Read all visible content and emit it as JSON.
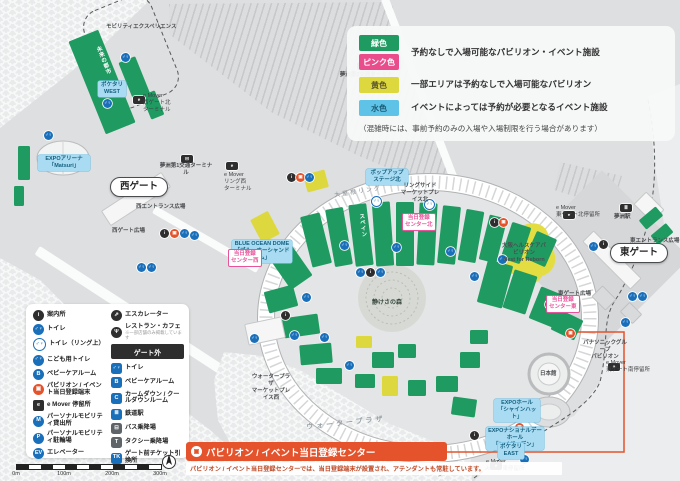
{
  "colors": {
    "green": "#1f9b62",
    "pink": "#ea4d8b",
    "yellow": "#ddd83e",
    "light_blue": "#5fc3e8",
    "orange": "#e4532c",
    "toilet_blue": "#1a6fba"
  },
  "legend": {
    "items": [
      {
        "chip": "緑色",
        "chip_bg": "#1f9b62",
        "desc": "予約なしで入場可能なパビリオン・イベント施設"
      },
      {
        "chip": "ピンク色",
        "chip_bg": "#ea4d8b",
        "desc": ""
      },
      {
        "chip": "黄色",
        "chip_bg": "#ddd83e",
        "desc": "一部エリアは予約なしで入場可能なパビリオン"
      },
      {
        "chip": "水色",
        "chip_bg": "#5fc3e8",
        "desc": "イベントによっては予約が必要となるイベント施設"
      }
    ],
    "note": "（混雑時には、事前予約のみの入場や入場制限を行う場合があります）"
  },
  "facility_legend": {
    "left": [
      {
        "icon": "info-icon",
        "style": "black-circle",
        "glyph": "i",
        "label": "案内所"
      },
      {
        "icon": "toilet-icon",
        "style": "blue-circle",
        "glyph": "♂♀",
        "label": "トイレ"
      },
      {
        "icon": "toilet-ring-icon",
        "style": "blue-ring",
        "glyph": "♂♀",
        "label": "トイレ（リング上）"
      },
      {
        "icon": "kids-toilet-icon",
        "style": "blue-circle",
        "glyph": "♂♀",
        "label": "こども用トイレ"
      },
      {
        "icon": "babycare-icon",
        "style": "blue-circle",
        "glyph": "B",
        "label": "ベビーケアルーム"
      },
      {
        "icon": "registration-terminal-icon",
        "style": "orange-circle",
        "glyph": "▣",
        "label": "パビリオン / イベント当日登録端末"
      },
      {
        "icon": "emover-stop-icon",
        "style": "black-square",
        "glyph": "e",
        "label": "e Mover 停留所"
      },
      {
        "icon": "mobility-rental-icon",
        "style": "blue-circle",
        "glyph": "M",
        "label": "パーソナルモビリティ貸出所"
      },
      {
        "icon": "mobility-parking-icon",
        "style": "blue-circle",
        "glyph": "P",
        "label": "パーソナルモビリティ駐輪場"
      },
      {
        "icon": "elevator-icon",
        "style": "blue-circle",
        "glyph": "EV",
        "label": "エレベーター"
      }
    ],
    "right_top": [
      {
        "icon": "escalator-icon",
        "style": "black-circle",
        "glyph": "⇗",
        "label": "エスカレーター"
      },
      {
        "icon": "restaurant-icon",
        "style": "black-circle",
        "glyph": "Ψ",
        "label": "レストラン・カフェ",
        "note": "※一部店舗のみ掲載しています"
      }
    ],
    "gate_header": "ゲート外",
    "right_bottom": [
      {
        "icon": "gate-toilet-icon",
        "style": "blue-square",
        "glyph": "♂♀",
        "label": "トイレ"
      },
      {
        "icon": "gate-babycare-icon",
        "style": "blue-square",
        "glyph": "B",
        "label": "ベビーケアルーム"
      },
      {
        "icon": "calmdown-icon",
        "style": "blue-square",
        "glyph": "C",
        "label": "カームダウン / クールダウンルーム"
      },
      {
        "icon": "station-icon",
        "style": "blue-square",
        "glyph": "≣",
        "label": "鉄道駅"
      },
      {
        "icon": "bus-icon",
        "style": "gray-square",
        "glyph": "⊟",
        "label": "バス乗降場"
      },
      {
        "icon": "taxi-icon",
        "style": "gray-square",
        "glyph": "T",
        "label": "タクシー乗降場"
      },
      {
        "icon": "ticket-icon",
        "style": "blue-square",
        "glyph": "TK",
        "label": "ゲート前チケット引換所"
      }
    ]
  },
  "banner": {
    "title": "パビリオン / イベント当日登録センター",
    "desc": "パビリオン / イベント当日登録センターでは、当日登録端末が設置され、アテンダントも常駐しています。"
  },
  "scale": {
    "ticks": [
      "0m",
      "100m",
      "200m",
      "300m"
    ]
  },
  "map": {
    "icon_styles": {
      "wc": "blue-circle",
      "wcr": "blue-ring",
      "info": "black-circle",
      "reg": "orange-circle",
      "emover": "black-rect",
      "busT": "black-rect",
      "station": "black-rect"
    },
    "icon_glyphs": {
      "wc": "♂♀",
      "wcr": "♂♀",
      "info": "i",
      "reg": "▣",
      "emover": "e",
      "busT": "⊟",
      "station": "≣"
    },
    "blocks": [
      {
        "x": 86,
        "y": 32,
        "w": 32,
        "h": 100,
        "r": -22,
        "c": "green",
        "n": "pavilion-future-city"
      },
      {
        "x": 126,
        "y": 58,
        "w": 18,
        "h": 44,
        "r": -22,
        "c": "green"
      },
      {
        "x": 146,
        "y": 92,
        "w": 14,
        "h": 26,
        "r": -22,
        "c": "green"
      },
      {
        "x": 18,
        "y": 146,
        "w": 12,
        "h": 34,
        "r": 0,
        "c": "green"
      },
      {
        "x": 14,
        "y": 186,
        "w": 10,
        "h": 20,
        "r": 0,
        "c": "green"
      },
      {
        "x": 100,
        "y": 190,
        "w": 70,
        "h": 16,
        "r": -33,
        "c": "white",
        "n": "west-gate-canopy"
      },
      {
        "x": 578,
        "y": 252,
        "w": 66,
        "h": 14,
        "r": 45,
        "c": "white",
        "n": "east-gate-canopy"
      },
      {
        "x": 636,
        "y": 198,
        "w": 24,
        "h": 16,
        "r": 45,
        "c": "white"
      },
      {
        "x": 305,
        "y": 172,
        "w": 22,
        "h": 18,
        "r": -15,
        "c": "yellow"
      },
      {
        "x": 255,
        "y": 214,
        "w": 20,
        "h": 26,
        "r": -28,
        "c": "yellow",
        "n": "blue-ocean-dome"
      },
      {
        "x": 306,
        "y": 214,
        "w": 20,
        "h": 52,
        "r": -14,
        "c": "green"
      },
      {
        "x": 330,
        "y": 208,
        "w": 18,
        "h": 58,
        "r": -10,
        "c": "green"
      },
      {
        "x": 352,
        "y": 204,
        "w": 18,
        "h": 62,
        "r": -7,
        "c": "green",
        "n": "pavilion-spain"
      },
      {
        "x": 374,
        "y": 202,
        "w": 18,
        "h": 64,
        "r": -4,
        "c": "green"
      },
      {
        "x": 396,
        "y": 202,
        "w": 18,
        "h": 64,
        "r": 0,
        "c": "green"
      },
      {
        "x": 418,
        "y": 203,
        "w": 18,
        "h": 62,
        "r": 3,
        "c": "green"
      },
      {
        "x": 440,
        "y": 206,
        "w": 18,
        "h": 58,
        "r": 6,
        "c": "green"
      },
      {
        "x": 462,
        "y": 210,
        "w": 18,
        "h": 52,
        "r": 10,
        "c": "green"
      },
      {
        "x": 484,
        "y": 216,
        "w": 18,
        "h": 46,
        "r": 14,
        "c": "green"
      },
      {
        "x": 506,
        "y": 224,
        "w": 20,
        "h": 38,
        "r": 18,
        "c": "green"
      },
      {
        "x": 530,
        "y": 234,
        "w": 22,
        "h": 30,
        "r": 24,
        "c": "green"
      },
      {
        "x": 278,
        "y": 248,
        "w": 26,
        "h": 38,
        "r": -35,
        "c": "green"
      },
      {
        "x": 266,
        "y": 288,
        "w": 30,
        "h": 22,
        "r": -15,
        "c": "green"
      },
      {
        "x": 283,
        "y": 316,
        "w": 36,
        "h": 20,
        "r": -8,
        "c": "green"
      },
      {
        "x": 300,
        "y": 344,
        "w": 32,
        "h": 20,
        "r": -5,
        "c": "green"
      },
      {
        "x": 246,
        "y": 320,
        "w": 36,
        "h": 20,
        "r": -12,
        "c": "white"
      },
      {
        "x": 316,
        "y": 368,
        "w": 26,
        "h": 16,
        "r": 0,
        "c": "green"
      },
      {
        "x": 356,
        "y": 336,
        "w": 16,
        "h": 12,
        "r": 0,
        "c": "yellow"
      },
      {
        "x": 372,
        "y": 352,
        "w": 22,
        "h": 16,
        "r": 0,
        "c": "green"
      },
      {
        "x": 398,
        "y": 344,
        "w": 18,
        "h": 14,
        "r": 0,
        "c": "green"
      },
      {
        "x": 355,
        "y": 374,
        "w": 20,
        "h": 14,
        "r": 0,
        "c": "green"
      },
      {
        "x": 382,
        "y": 376,
        "w": 16,
        "h": 20,
        "r": 0,
        "c": "yellow"
      },
      {
        "x": 408,
        "y": 380,
        "w": 18,
        "h": 16,
        "r": 0,
        "c": "green"
      },
      {
        "x": 436,
        "y": 376,
        "w": 22,
        "h": 16,
        "r": 0,
        "c": "green"
      },
      {
        "x": 452,
        "y": 398,
        "w": 24,
        "h": 18,
        "r": 8,
        "c": "green"
      },
      {
        "x": 460,
        "y": 352,
        "w": 20,
        "h": 16,
        "r": 0,
        "c": "green"
      },
      {
        "x": 470,
        "y": 330,
        "w": 18,
        "h": 14,
        "r": 0,
        "c": "green"
      },
      {
        "x": 482,
        "y": 262,
        "w": 26,
        "h": 44,
        "r": 15,
        "c": "green"
      },
      {
        "x": 508,
        "y": 272,
        "w": 24,
        "h": 40,
        "r": 18,
        "c": "green"
      },
      {
        "x": 534,
        "y": 290,
        "w": 26,
        "h": 34,
        "r": 22,
        "c": "green"
      },
      {
        "x": 554,
        "y": 314,
        "w": 26,
        "h": 22,
        "r": 26,
        "c": "green"
      },
      {
        "x": 640,
        "y": 212,
        "w": 22,
        "h": 12,
        "r": -40,
        "c": "green"
      },
      {
        "x": 652,
        "y": 228,
        "w": 20,
        "h": 12,
        "r": -40,
        "c": "green"
      },
      {
        "x": 594,
        "y": 290,
        "w": 18,
        "h": 14,
        "r": 45,
        "c": "gray"
      },
      {
        "x": 622,
        "y": 306,
        "w": 16,
        "h": 12,
        "r": 45,
        "c": "gray"
      }
    ],
    "icons": [
      {
        "x": 121,
        "y": 53,
        "t": "wc"
      },
      {
        "x": 103,
        "y": 99,
        "t": "wc"
      },
      {
        "x": 44,
        "y": 131,
        "t": "wc"
      },
      {
        "x": 133,
        "y": 96,
        "t": "emover"
      },
      {
        "x": 181,
        "y": 155,
        "t": "busT"
      },
      {
        "x": 357,
        "y": 62,
        "t": "busT"
      },
      {
        "x": 370,
        "y": 61,
        "t": "wc"
      },
      {
        "x": 160,
        "y": 229,
        "t": "info"
      },
      {
        "x": 170,
        "y": 229,
        "t": "reg"
      },
      {
        "x": 180,
        "y": 229,
        "t": "wc"
      },
      {
        "x": 190,
        "y": 231,
        "t": "wc"
      },
      {
        "x": 137,
        "y": 263,
        "t": "wc"
      },
      {
        "x": 147,
        "y": 263,
        "t": "wc"
      },
      {
        "x": 226,
        "y": 162,
        "t": "emover"
      },
      {
        "x": 287,
        "y": 173,
        "t": "info"
      },
      {
        "x": 296,
        "y": 173,
        "t": "reg"
      },
      {
        "x": 305,
        "y": 173,
        "t": "wc"
      },
      {
        "x": 371,
        "y": 196,
        "t": "wcr"
      },
      {
        "x": 424,
        "y": 199,
        "t": "wcr"
      },
      {
        "x": 340,
        "y": 241,
        "t": "wc"
      },
      {
        "x": 392,
        "y": 243,
        "t": "wc"
      },
      {
        "x": 446,
        "y": 247,
        "t": "wc"
      },
      {
        "x": 498,
        "y": 255,
        "t": "wc"
      },
      {
        "x": 356,
        "y": 268,
        "t": "wc"
      },
      {
        "x": 366,
        "y": 268,
        "t": "info"
      },
      {
        "x": 376,
        "y": 268,
        "t": "wc"
      },
      {
        "x": 302,
        "y": 293,
        "t": "wc"
      },
      {
        "x": 281,
        "y": 311,
        "t": "info"
      },
      {
        "x": 290,
        "y": 331,
        "t": "wc"
      },
      {
        "x": 320,
        "y": 333,
        "t": "wc"
      },
      {
        "x": 345,
        "y": 361,
        "t": "wc"
      },
      {
        "x": 250,
        "y": 334,
        "t": "wc"
      },
      {
        "x": 545,
        "y": 300,
        "t": "wc"
      },
      {
        "x": 557,
        "y": 302,
        "t": "info"
      },
      {
        "x": 470,
        "y": 272,
        "t": "wc"
      },
      {
        "x": 490,
        "y": 218,
        "t": "info"
      },
      {
        "x": 499,
        "y": 218,
        "t": "reg"
      },
      {
        "x": 589,
        "y": 242,
        "t": "wc"
      },
      {
        "x": 599,
        "y": 240,
        "t": "info"
      },
      {
        "x": 628,
        "y": 292,
        "t": "wc"
      },
      {
        "x": 638,
        "y": 292,
        "t": "wc"
      },
      {
        "x": 621,
        "y": 318,
        "t": "wc"
      },
      {
        "x": 620,
        "y": 204,
        "t": "station"
      },
      {
        "x": 563,
        "y": 211,
        "t": "emover"
      },
      {
        "x": 608,
        "y": 363,
        "t": "emover"
      },
      {
        "x": 490,
        "y": 462,
        "t": "emover"
      },
      {
        "x": 470,
        "y": 431,
        "t": "info"
      },
      {
        "x": 515,
        "y": 423,
        "t": "reg"
      },
      {
        "x": 520,
        "y": 455,
        "t": "wc"
      },
      {
        "x": 566,
        "y": 329,
        "t": "reg"
      }
    ],
    "labels": [
      {
        "text": "モビリティエクスペリエンス",
        "x": 106,
        "y": 24,
        "c": "plain",
        "n": "label-mobility-experience"
      },
      {
        "text": "夢洲第2交通ターミナル",
        "x": 338,
        "y": 72,
        "w": 56,
        "c": "plain",
        "n": "label-yumeshima-terminal-2"
      },
      {
        "text": "夢洲第1交通ターミナル",
        "x": 158,
        "y": 163,
        "w": 56,
        "c": "plain",
        "n": "label-yumeshima-terminal-1"
      },
      {
        "text": "e Mover\n西ゲート北\nターミナル",
        "x": 143,
        "y": 93,
        "c": "plain-left",
        "n": "label-emover-west-north"
      },
      {
        "text": "e Mover\nリング西\nターミナル",
        "x": 224,
        "y": 172,
        "c": "plain-left",
        "n": "label-emover-ring-west"
      },
      {
        "text": "ポケタリ\nWEST",
        "x": 98,
        "y": 81,
        "w": 24,
        "c": "blue",
        "n": "label-pocketari-west"
      },
      {
        "text": "EXPOアリーナ\n「Matsuri」",
        "x": 38,
        "y": 155,
        "w": 48,
        "c": "blue",
        "n": "label-expo-arena"
      },
      {
        "text": "西ゲート",
        "x": 110,
        "y": 177,
        "c": "gate",
        "n": "label-west-gate"
      },
      {
        "text": "東ゲート",
        "x": 610,
        "y": 243,
        "c": "gate",
        "n": "label-east-gate"
      },
      {
        "text": "西エントランス広場",
        "x": 136,
        "y": 204,
        "c": "plain",
        "n": "label-west-entrance-plaza"
      },
      {
        "text": "西ゲート広場",
        "x": 112,
        "y": 228,
        "c": "plain",
        "n": "label-west-gate-plaza"
      },
      {
        "text": "東エントランス広場",
        "x": 630,
        "y": 238,
        "c": "plain",
        "n": "label-east-entrance-plaza"
      },
      {
        "text": "東ゲート広場",
        "x": 558,
        "y": 291,
        "c": "plain",
        "n": "label-east-gate-plaza"
      },
      {
        "text": "大屋根リング",
        "x": 334,
        "y": 193,
        "r": -9,
        "c": "ring",
        "n": "label-grand-ring"
      },
      {
        "text": "大屋根リング",
        "x": 398,
        "y": 467,
        "r": 7,
        "c": "ring",
        "n": "label-grand-ring-2"
      },
      {
        "text": "静けさの森",
        "x": 372,
        "y": 300,
        "c": "forest",
        "n": "label-forest-of-tranquility"
      },
      {
        "text": "ウォータープラザ",
        "x": 306,
        "y": 424,
        "r": -6,
        "c": "water",
        "n": "label-water-plaza"
      },
      {
        "text": "BLUE OCEAN DOME\n「ブルーオーシャンドーム」",
        "x": 232,
        "y": 240,
        "w": 56,
        "c": "blue",
        "n": "label-blue-ocean-dome"
      },
      {
        "text": "ポップアップステージ北",
        "x": 366,
        "y": 169,
        "w": 38,
        "c": "blue",
        "n": "label-popup-stage-north"
      },
      {
        "text": "リングサイド\nマーケットプレイス北",
        "x": 398,
        "y": 183,
        "w": 44,
        "c": "plain",
        "n": "label-ringside-marketplace-north"
      },
      {
        "text": "ウォータープラザ\nマーケットプレイス西",
        "x": 250,
        "y": 374,
        "w": 42,
        "c": "plain",
        "n": "label-waterplaza-marketplace-west"
      },
      {
        "text": "当日登録\nセンター西",
        "x": 228,
        "y": 249,
        "c": "pink",
        "n": "label-registration-center-west"
      },
      {
        "text": "当日登録\nセンター北",
        "x": 402,
        "y": 213,
        "c": "pink",
        "n": "label-registration-center-north"
      },
      {
        "text": "当日登録\nセンター東",
        "x": 546,
        "y": 295,
        "c": "pink",
        "n": "label-registration-center-east"
      },
      {
        "text": "大阪ヘルスケアパビリオン\nNest for Reborn",
        "x": 500,
        "y": 243,
        "w": 48,
        "c": "plain",
        "n": "label-osaka-healthcare-pavilion"
      },
      {
        "text": "日本館",
        "x": 540,
        "y": 371,
        "c": "plain",
        "n": "label-japan-pavilion"
      },
      {
        "text": "EXPOホール\n「シャインハット」",
        "x": 494,
        "y": 399,
        "w": 42,
        "c": "blue",
        "n": "label-expo-hall"
      },
      {
        "text": "EXPOナショナルデーホール\n「レイガーデン」",
        "x": 486,
        "y": 427,
        "w": 54,
        "c": "blue",
        "n": "label-national-day-hall"
      },
      {
        "text": "ポケタリ\nEAST",
        "x": 498,
        "y": 443,
        "w": 22,
        "c": "blue",
        "n": "label-pocketari-east"
      },
      {
        "text": "e Mover\nリング東停留所",
        "x": 486,
        "y": 459,
        "c": "plain-left",
        "n": "label-emover-ring-east"
      },
      {
        "text": "e Mover\n東ゲート北停留所",
        "x": 556,
        "y": 205,
        "c": "plain-left",
        "n": "label-emover-east-north"
      },
      {
        "text": "e Mover\n東ゲート南停留所",
        "x": 606,
        "y": 360,
        "c": "plain-left",
        "n": "label-emover-east-south"
      },
      {
        "text": "パナソニックグループ\nパビリオン",
        "x": 582,
        "y": 340,
        "w": 46,
        "c": "plain",
        "n": "label-panasonic-pavilion"
      },
      {
        "text": "夢洲駅",
        "x": 614,
        "y": 214,
        "c": "plain",
        "n": "label-yumeshima-station"
      },
      {
        "text": "スペイン",
        "x": 357,
        "y": 214,
        "r": -7,
        "c": "vgreen",
        "n": "label-spain"
      },
      {
        "text": "未来の都市",
        "x": 94,
        "y": 48,
        "r": -22,
        "c": "vgreen",
        "n": "label-future-city"
      }
    ]
  }
}
